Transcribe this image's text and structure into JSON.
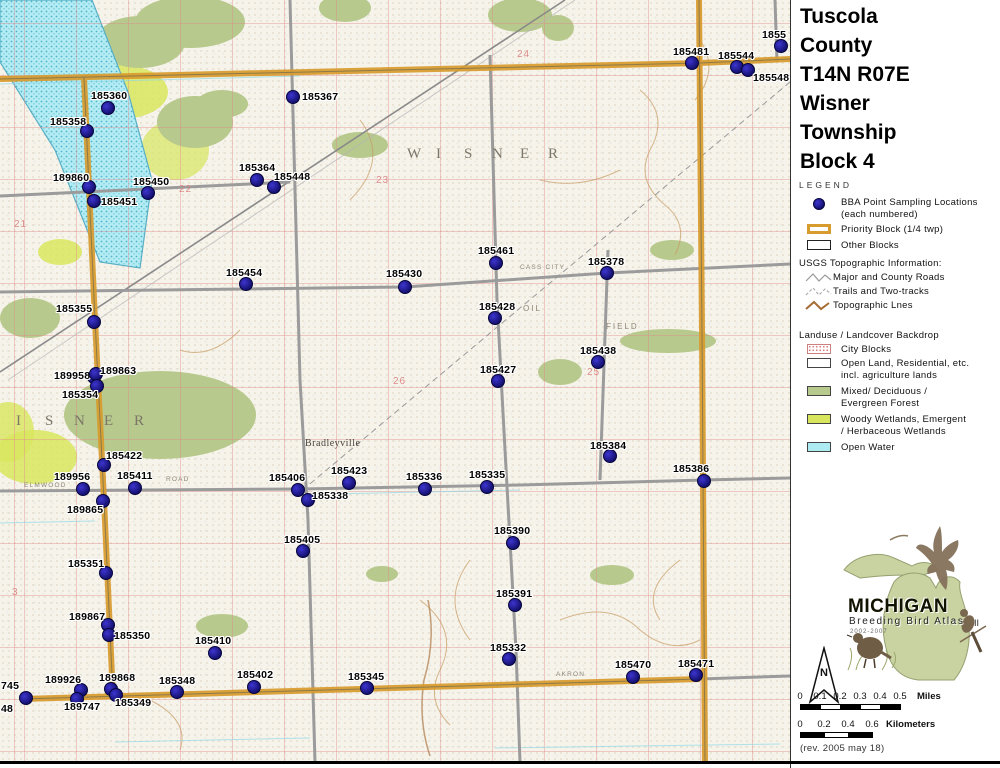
{
  "title": {
    "lines": [
      "Tuscola",
      "County",
      "T14N R07E",
      "Wisner",
      "Township",
      "Block 4"
    ]
  },
  "legend": {
    "heading": "LEGEND",
    "bba_line1": "BBA Point Sampling Locations",
    "bba_line2": "(each numbered)",
    "priority_block": "Priority Block (1/4 twp)",
    "other_blocks": "Other Blocks",
    "usgs_heading": "USGS Topographic Information:",
    "usgs_items": [
      "Major and County Roads",
      "Trails and Two-tracks",
      "Topographic Lnes"
    ],
    "landuse_heading": "Landuse / Landcover Backdrop",
    "landuse_rows": [
      {
        "line1": "City Blocks",
        "line2": ""
      },
      {
        "line1": "Open Land, Residential, etc.",
        "line2": "incl. agriculture lands"
      },
      {
        "line1": "Mixed/ Deciduous /",
        "line2": "Evergreen Forest"
      },
      {
        "line1": "Woody Wetlands, Emergent",
        "line2": "/ Herbaceous Wetlands"
      },
      {
        "line1": "Open Water",
        "line2": ""
      }
    ]
  },
  "logo": {
    "name": "MICHIGAN",
    "subtitle": "Breeding Bird Atlas",
    "years": "2002-2007",
    "numeral": "II"
  },
  "compass": {
    "n": "N"
  },
  "scale_miles": {
    "ticks": [
      "0",
      "0.1",
      "0.2",
      "0.3",
      "0.4",
      "0.5"
    ],
    "unit": "Miles",
    "x0": 800,
    "label_y": 691,
    "bar_y": 704,
    "seg_w": 20,
    "segs": 5,
    "unit_x": 917
  },
  "scale_km": {
    "ticks": [
      "0",
      "0.2",
      "0.4",
      "0.6"
    ],
    "unit": "Kilometers",
    "x0": 800,
    "label_y": 719,
    "bar_y": 732,
    "seg_w": 24,
    "segs": 3,
    "unit_x": 886
  },
  "revision": "(rev. 2005 may 18)",
  "colors": {
    "point": "#1c17a3",
    "priority": "#d89b2d",
    "forest": "#b7c98c",
    "wetland": "#d8e65e",
    "water": "#aeeaf2",
    "road": "#999999"
  },
  "map": {
    "points": [
      {
        "id": "185360",
        "dot": [
          108,
          108
        ],
        "label": [
          91,
          90
        ]
      },
      {
        "id": "185358",
        "dot": [
          87,
          131
        ],
        "label": [
          50,
          116
        ]
      },
      {
        "id": "185367",
        "dot": [
          293,
          97
        ],
        "label": [
          302,
          91
        ]
      },
      {
        "id": "189860",
        "dot": [
          89,
          187
        ],
        "label": [
          53,
          172
        ]
      },
      {
        "id": "185450",
        "dot": [
          148,
          193
        ],
        "label": [
          133,
          176
        ]
      },
      {
        "id": "185451",
        "dot": [
          94,
          201
        ],
        "label": [
          101,
          196
        ]
      },
      {
        "id": "185364",
        "dot": [
          257,
          180
        ],
        "label": [
          239,
          162
        ]
      },
      {
        "id": "185448",
        "dot": [
          274,
          187
        ],
        "label": [
          274,
          171
        ]
      },
      {
        "id": "185481",
        "dot": [
          692,
          63
        ],
        "label": [
          673,
          46
        ]
      },
      {
        "id": "185544",
        "dot": [
          737,
          67
        ],
        "label": [
          718,
          50
        ]
      },
      {
        "id": "185548",
        "dot": [
          748,
          70
        ],
        "label": [
          753,
          72
        ]
      },
      {
        "id": "1855",
        "dot": [
          781,
          46
        ],
        "label": [
          762,
          29
        ]
      },
      {
        "id": "185454",
        "dot": [
          246,
          284
        ],
        "label": [
          226,
          267
        ]
      },
      {
        "id": "185430",
        "dot": [
          405,
          287
        ],
        "label": [
          386,
          268
        ]
      },
      {
        "id": "185461",
        "dot": [
          496,
          263
        ],
        "label": [
          478,
          245
        ]
      },
      {
        "id": "185378",
        "dot": [
          607,
          273
        ],
        "label": [
          588,
          256
        ]
      },
      {
        "id": "185428",
        "dot": [
          495,
          318
        ],
        "label": [
          479,
          301
        ]
      },
      {
        "id": "185438",
        "dot": [
          598,
          362
        ],
        "label": [
          580,
          345
        ]
      },
      {
        "id": "185427",
        "dot": [
          498,
          381
        ],
        "label": [
          480,
          364
        ]
      },
      {
        "id": "185355",
        "dot": [
          94,
          322
        ],
        "label": [
          56,
          303
        ]
      },
      {
        "id": "189958",
        "dot": [
          94,
          377
        ],
        "label": [
          54,
          370
        ]
      },
      {
        "id": "189863",
        "dot": [
          96,
          374
        ],
        "label": [
          100,
          365
        ]
      },
      {
        "id": "185354",
        "dot": [
          97,
          386
        ],
        "label": [
          62,
          389
        ]
      },
      {
        "id": "185422",
        "dot": [
          104,
          465
        ],
        "label": [
          106,
          450
        ]
      },
      {
        "id": "189956",
        "dot": [
          83,
          489
        ],
        "label": [
          54,
          471
        ]
      },
      {
        "id": "185411",
        "dot": [
          135,
          488
        ],
        "label": [
          117,
          470
        ]
      },
      {
        "id": "189865",
        "dot": [
          103,
          501
        ],
        "label": [
          67,
          504
        ]
      },
      {
        "id": "185351",
        "dot": [
          106,
          573
        ],
        "label": [
          68,
          558
        ]
      },
      {
        "id": "185384",
        "dot": [
          610,
          456
        ],
        "label": [
          590,
          440
        ]
      },
      {
        "id": "185386",
        "dot": [
          704,
          481
        ],
        "label": [
          673,
          463
        ]
      },
      {
        "id": "185423",
        "dot": [
          349,
          483
        ],
        "label": [
          331,
          465
        ]
      },
      {
        "id": "185336",
        "dot": [
          425,
          489
        ],
        "label": [
          406,
          471
        ]
      },
      {
        "id": "185335",
        "dot": [
          487,
          487
        ],
        "label": [
          469,
          469
        ]
      },
      {
        "id": "185406",
        "dot": [
          298,
          490
        ],
        "label": [
          269,
          472
        ]
      },
      {
        "id": "185338",
        "dot": [
          308,
          500
        ],
        "label": [
          312,
          490
        ]
      },
      {
        "id": "185405",
        "dot": [
          303,
          551
        ],
        "label": [
          284,
          534
        ]
      },
      {
        "id": "185390",
        "dot": [
          513,
          543
        ],
        "label": [
          494,
          525
        ]
      },
      {
        "id": "185391",
        "dot": [
          515,
          605
        ],
        "label": [
          496,
          588
        ]
      },
      {
        "id": "185332",
        "dot": [
          509,
          659
        ],
        "label": [
          490,
          642
        ]
      },
      {
        "id": "185470",
        "dot": [
          633,
          677
        ],
        "label": [
          615,
          659
        ]
      },
      {
        "id": "185471",
        "dot": [
          696,
          675
        ],
        "label": [
          678,
          658
        ]
      },
      {
        "id": "189867",
        "dot": [
          108,
          625
        ],
        "label": [
          69,
          611
        ]
      },
      {
        "id": "185350",
        "dot": [
          109,
          635
        ],
        "label": [
          114,
          630
        ]
      },
      {
        "id": "185410",
        "dot": [
          215,
          653
        ],
        "label": [
          195,
          635
        ]
      },
      {
        "id": "189926",
        "dot": [
          81,
          690
        ],
        "label": [
          45,
          674
        ]
      },
      {
        "id": "189868",
        "dot": [
          111,
          689
        ],
        "label": [
          99,
          672
        ]
      },
      {
        "id": "185349",
        "dot": [
          116,
          695
        ],
        "label": [
          115,
          697
        ]
      },
      {
        "id": "189747",
        "dot": [
          77,
          699
        ],
        "label": [
          64,
          701
        ]
      },
      {
        "id": "185348",
        "dot": [
          177,
          692
        ],
        "label": [
          159,
          675
        ]
      },
      {
        "id": "185402",
        "dot": [
          254,
          687
        ],
        "label": [
          237,
          669
        ]
      },
      {
        "id": "185345",
        "dot": [
          367,
          688
        ],
        "label": [
          348,
          671
        ]
      },
      {
        "id": "745",
        "dot": [
          26,
          698
        ],
        "label": [
          1,
          680
        ]
      },
      {
        "id": "48",
        "dot": null,
        "label": [
          1,
          703
        ]
      }
    ],
    "sections": [
      {
        "n": "21",
        "x": 14,
        "y": 219
      },
      {
        "n": "22",
        "x": 179,
        "y": 184
      },
      {
        "n": "23",
        "x": 376,
        "y": 175
      },
      {
        "n": "24",
        "x": 517,
        "y": 49
      },
      {
        "n": "25",
        "x": 587,
        "y": 367
      },
      {
        "n": "26",
        "x": 393,
        "y": 376
      },
      {
        "n": "3",
        "x": 12,
        "y": 587
      }
    ],
    "road_labels": [
      {
        "t": "ELMWOOD",
        "x": 24,
        "y": 482
      },
      {
        "t": "ROAD",
        "x": 166,
        "y": 476
      },
      {
        "t": "CASS CITY",
        "x": 520,
        "y": 264
      },
      {
        "t": "AKRON",
        "x": 556,
        "y": 671
      }
    ],
    "feature_labels": [
      {
        "t": "OIL",
        "x": 523,
        "y": 304
      },
      {
        "t": "FIELD",
        "x": 606,
        "y": 322
      }
    ],
    "town_name": {
      "t": "Bradleyville",
      "x": 305,
      "y": 438
    },
    "township_top": {
      "text": "WISNER",
      "y": 146,
      "xs": [
        407,
        436,
        464,
        492,
        520,
        548
      ]
    },
    "township_left": {
      "text": "ISNER",
      "y": 413,
      "xs": [
        16,
        45,
        74,
        104,
        134
      ]
    }
  }
}
